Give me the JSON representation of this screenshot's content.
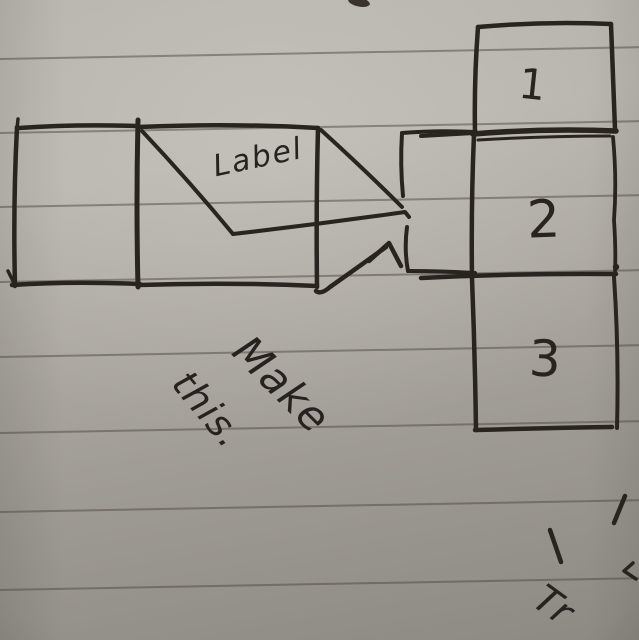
{
  "sketch": {
    "flag": {
      "text": "Label"
    },
    "column": {
      "cells": [
        {
          "number": "1"
        },
        {
          "number": "2"
        },
        {
          "number": "3"
        }
      ]
    },
    "note": {
      "line1": "Make",
      "line2": "this."
    },
    "corner": {
      "fragment": "Tr"
    },
    "colors": {
      "ink": "#2a2420",
      "paper": "#aeaaa3",
      "ruled_line": "#6e6961"
    }
  }
}
